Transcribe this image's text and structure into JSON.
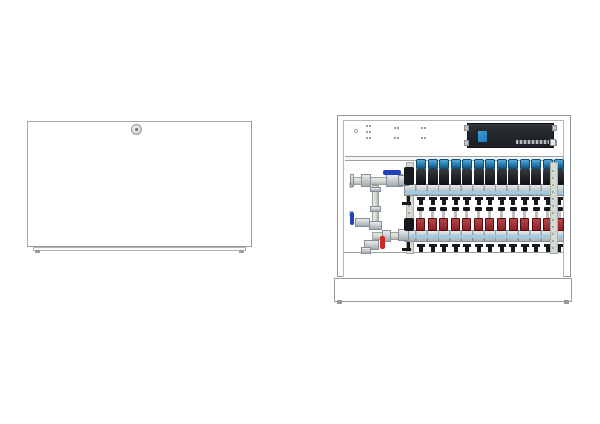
{
  "colors": {
    "frame": "#8f9296",
    "frame-inner": "#b4b7ba",
    "panel-white": "#ffffff",
    "actuator-blue": "#2e86bb",
    "actuator-blue-dark": "#14557f",
    "actuator-black": "#1b1e22",
    "bar-silver-light": "#e6e9eb",
    "bar-silver-dark": "#a9b1b7",
    "bar-edge": "#868d93",
    "stripe-blue": "#9ecbe4",
    "meter-red": "#8e2024",
    "meter-red-light": "#b2474b",
    "cap-black": "#17191c",
    "lever-blue": "#2341bd",
    "lever-red": "#cd2824",
    "pipe-green-grey": "#d6dcd6",
    "fitting-silver": "#c3c9ce",
    "bracket": "#d4dad2",
    "bracket-edge": "#a8b0a6",
    "controller-body": "#26292e",
    "controller-logo": "#1e7ab8",
    "hole-grey": "#9aa0a5"
  },
  "left_unit": {
    "component": "manifold-cabinet-front-door-closed",
    "lock_icon": "cylinder-lock-icon"
  },
  "right_unit": {
    "component": "manifold-cabinet-open-interior",
    "controller": {
      "icon": "wiring-center-unit",
      "logo_icon": "brand-logo-mark",
      "terminal_strips": 1,
      "mounting_tabs": 4
    },
    "top_panel": {
      "mounting_hole_pairs": 7,
      "key_hole": 1
    },
    "upper_manifold": {
      "ports": 13,
      "part": "supply-manifold-with-thermal-actuators"
    },
    "lower_manifold": {
      "ports": 13,
      "part": "return-manifold-with-flow-meters"
    },
    "valves": {
      "blue_levers": 2,
      "red_levers": 1,
      "black_drain_valves": 2
    },
    "support_brackets": 2
  }
}
